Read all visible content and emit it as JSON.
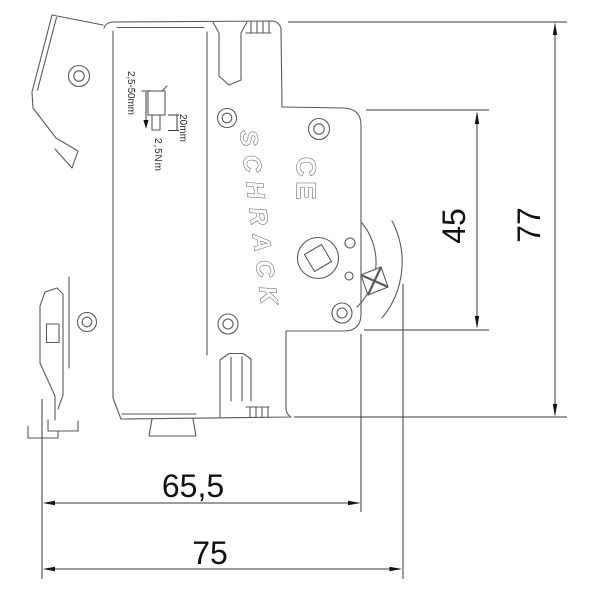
{
  "drawing": {
    "brand_logo": "SCHRACK",
    "ce_mark": "CE",
    "dimensions": {
      "total_height_mm": "77",
      "face_height_mm": "45",
      "depth_to_face_mm": "65,5",
      "total_depth_mm": "75"
    },
    "terminal_info": {
      "wire_range": "2,5-50mm",
      "strip_length": "20mm",
      "tightening_torque": "2,5Nm"
    },
    "colors": {
      "outline": "#5a5a5a",
      "dimension_line": "#3a3a3a",
      "text": "#111111",
      "background": "#ffffff"
    }
  }
}
